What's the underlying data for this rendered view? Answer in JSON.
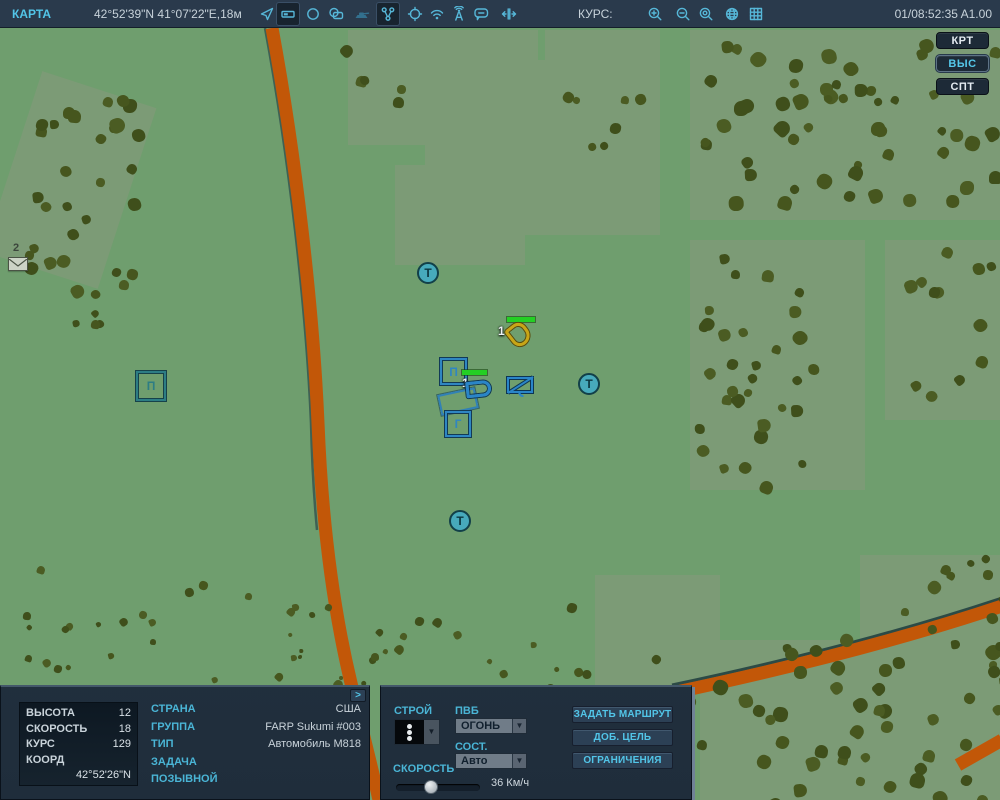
{
  "top_bar": {
    "title": "КАРТА",
    "coordinates": "42°52'39\"N 41°07'22\"E,18м",
    "course_label": "КУРС:",
    "clock": "01/08:52:35 A1.00"
  },
  "layer_buttons": {
    "map": "КРТ",
    "alt": "ВЫС",
    "sat": "СПТ"
  },
  "map": {
    "message_count": "2",
    "waypoint_letter": "Т",
    "symbol_p": "П",
    "symbol_g": "Г",
    "enemy_unit_count": "1",
    "own_unit_count": "1"
  },
  "telemetry": {
    "altitude_label": "ВЫСОТА",
    "altitude": "12",
    "speed_label": "СКОРОСТЬ",
    "speed": "18",
    "course_label": "КУРС",
    "course": "129",
    "coord_label": "КООРД",
    "coord": "42°52'26\"N",
    "expand": ">"
  },
  "details": {
    "country_label": "СТРАНА",
    "country": "США",
    "group_label": "ГРУППА",
    "group": "FARP Sukumi #003",
    "type_label": "ТИП",
    "type": "Автомобиль М818",
    "task_label": "ЗАДАЧА",
    "task": "",
    "callsign_label": "ПОЗЫВНОЙ",
    "callsign": ""
  },
  "command": {
    "formation_label": "СТРОЙ",
    "roe_label": "ПВБ",
    "roe": "ОГОНЬ",
    "state_label": "СОСТ.",
    "state": "Авто",
    "speed_label": "СКОРОСТЬ",
    "speed": "36 Км/ч",
    "route_btn": "ЗАДАТЬ МАРШРУТ",
    "target_btn": "ДОБ. ЦЕЛЬ",
    "limits_btn": "ОГРАНИЧЕНИЯ"
  },
  "colors": {
    "accent_cyan": "#52c5e8",
    "friendly_blue": "#2f86c2",
    "enemy_gold": "#c8a516",
    "health_green": "#24cf24",
    "road_orange": "#c25708"
  }
}
